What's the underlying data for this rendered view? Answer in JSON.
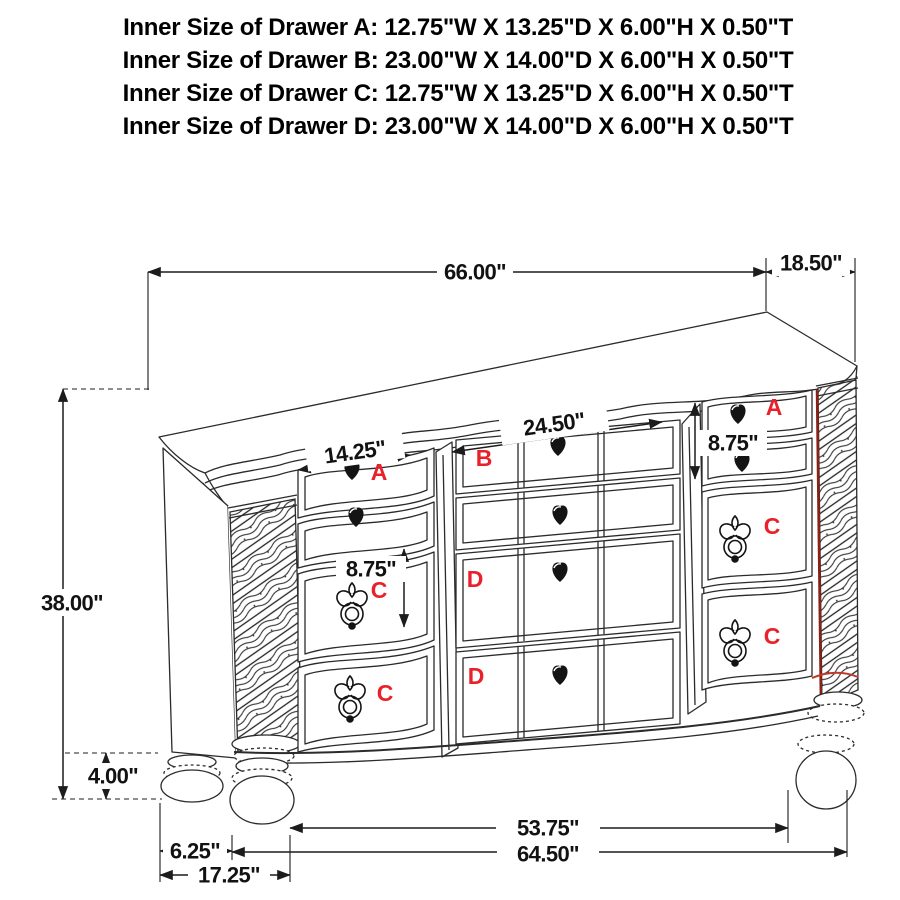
{
  "specs": {
    "lines": [
      "Inner Size of Drawer A: 12.75\"W X 13.25\"D X 6.00\"H X 0.50\"T",
      "Inner Size of Drawer B: 23.00\"W X 14.00\"D X 6.00\"H X 0.50\"T",
      "Inner Size of Drawer C: 12.75\"W X 13.25\"D X 6.00\"H X 0.50\"T",
      "Inner Size of Drawer D: 23.00\"W X 14.00\"D X 6.00\"H X 0.50\"T"
    ]
  },
  "dimensions": {
    "overall_width": "66.00\"",
    "top_depth": "18.50\"",
    "overall_height": "38.00\"",
    "foot_height": "4.00\"",
    "small_drawer_width": "14.25\"",
    "center_drawer_width": "24.50\"",
    "right_drawer_stack_height": "8.75\"",
    "left_drawer_height": "8.75\"",
    "front_feet_span": "53.75\"",
    "base_width": "64.50\"",
    "side_foot_inset": "6.25\"",
    "front_foot_inset": "17.25\""
  },
  "drawer_labels": {
    "left_top": "A",
    "center_top": "B",
    "right_top": "A",
    "left_middle": "C",
    "left_bottom": "C",
    "right_middle": "C",
    "right_bottom": "C",
    "center_middle": "D",
    "center_bottom": "D"
  },
  "colors": {
    "label": "#e8212a",
    "accent_dark": "#8a2016",
    "accent_bright": "#c0392b"
  }
}
